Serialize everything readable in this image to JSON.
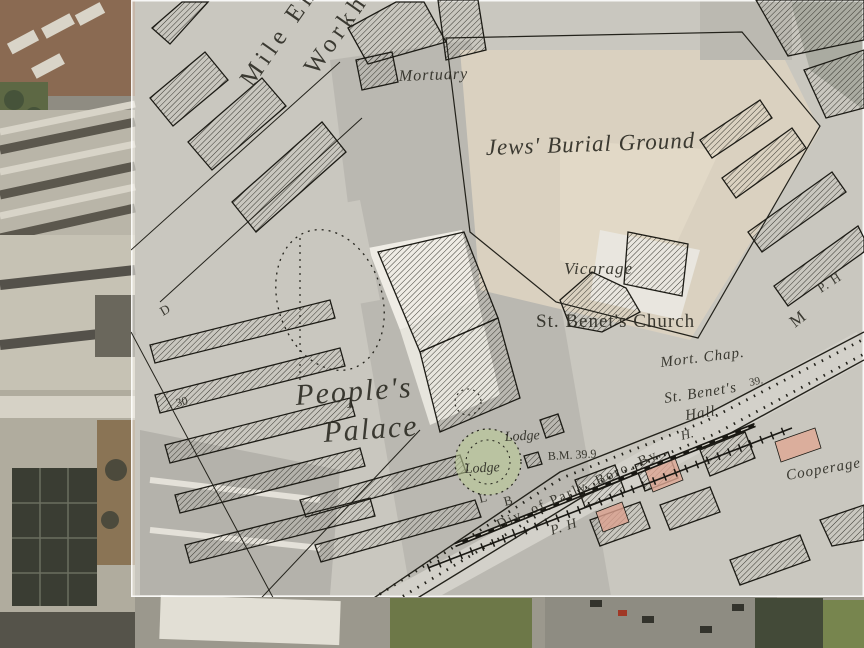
{
  "map": {
    "description_labels": "historic Ordnance Survey overlay on aerial photograph",
    "colors": {
      "paper": "rgba(251,250,244,0.54)",
      "ink": "#2b2a22",
      "garden_green": "rgba(186,202,150,0.6)",
      "building_pink": "#dda693",
      "aerial_base": "#8f8c82"
    },
    "labels": [
      {
        "text": "Mile End",
        "x": 252,
        "y": 88,
        "rot": -55,
        "size": 25,
        "style": "roman",
        "ls": 5
      },
      {
        "text": "Workhouse",
        "x": 316,
        "y": 76,
        "rot": -55,
        "size": 25,
        "style": "roman",
        "ls": 5
      },
      {
        "text": "Mortuary",
        "x": 399,
        "y": 81,
        "rot": -2,
        "size": 16,
        "style": "italic",
        "ls": 1
      },
      {
        "text": "Jews' Burial Ground",
        "x": 486,
        "y": 155,
        "rot": -2,
        "size": 23,
        "style": "italic",
        "ls": 1
      },
      {
        "text": "Vicarage",
        "x": 564,
        "y": 274,
        "rot": 0,
        "size": 17,
        "style": "italic",
        "ls": 1
      },
      {
        "text": "St. Benet's Church",
        "x": 536,
        "y": 327,
        "rot": 0,
        "size": 19,
        "style": "roman",
        "ls": 1
      },
      {
        "text": "Mort. Chap.",
        "x": 661,
        "y": 367,
        "rot": -7,
        "size": 15,
        "style": "italic",
        "ls": 1
      },
      {
        "text": "39.",
        "x": 750,
        "y": 386,
        "rot": -12,
        "size": 11,
        "style": "roman",
        "ls": 0
      },
      {
        "text": "St. Benet's",
        "x": 665,
        "y": 403,
        "rot": -9,
        "size": 15,
        "style": "italic",
        "ls": 1
      },
      {
        "text": "Hall",
        "x": 686,
        "y": 420,
        "rot": -9,
        "size": 15,
        "style": "italic",
        "ls": 1
      },
      {
        "text": "H.",
        "x": 682,
        "y": 440,
        "rot": -15,
        "size": 13,
        "style": "italic",
        "ls": 0
      },
      {
        "text": "People's",
        "x": 296,
        "y": 405,
        "rot": -4,
        "size": 30,
        "style": "italic",
        "ls": 2
      },
      {
        "text": "Palace",
        "x": 324,
        "y": 442,
        "rot": -4,
        "size": 30,
        "style": "italic",
        "ls": 2
      },
      {
        "text": "Lodge",
        "x": 505,
        "y": 441,
        "rot": -3,
        "size": 14,
        "style": "italic",
        "ls": 0
      },
      {
        "text": "Lodge",
        "x": 465,
        "y": 473,
        "rot": -3,
        "size": 14,
        "style": "italic",
        "ls": 0
      },
      {
        "text": "B.M. 39.9",
        "x": 548,
        "y": 460,
        "rot": -3,
        "size": 12,
        "style": "roman",
        "ls": 0
      },
      {
        "text": "L",
        "x": 480,
        "y": 503,
        "rot": -15,
        "size": 13,
        "style": "roman",
        "ls": 0
      },
      {
        "text": "B",
        "x": 505,
        "y": 506,
        "rot": -15,
        "size": 13,
        "style": "roman",
        "ls": 0
      },
      {
        "text": "Div. of Parly. Boro. By.",
        "x": 499,
        "y": 529,
        "rot": -24,
        "size": 14,
        "style": "roman",
        "ls": 2
      },
      {
        "text": "P. H",
        "x": 552,
        "y": 535,
        "rot": -18,
        "size": 14,
        "style": "italic",
        "ls": 1
      },
      {
        "text": "Cooperage",
        "x": 787,
        "y": 480,
        "rot": -10,
        "size": 15,
        "style": "italic",
        "ls": 1
      },
      {
        "text": "P. H",
        "x": 821,
        "y": 293,
        "rot": -33,
        "size": 13,
        "style": "roman",
        "ls": 1
      },
      {
        "text": "M",
        "x": 795,
        "y": 328,
        "rot": -38,
        "size": 17,
        "style": "roman",
        "ls": 0
      },
      {
        "text": "30",
        "x": 177,
        "y": 407,
        "rot": -15,
        "size": 12,
        "style": "roman",
        "ls": 0
      },
      {
        "text": "D",
        "x": 163,
        "y": 316,
        "rot": -30,
        "size": 13,
        "style": "roman",
        "ls": 0
      },
      {
        "text": "ll",
        "x": 124,
        "y": 293,
        "rot": -20,
        "size": 13,
        "style": "italic",
        "ls": 0
      }
    ]
  }
}
